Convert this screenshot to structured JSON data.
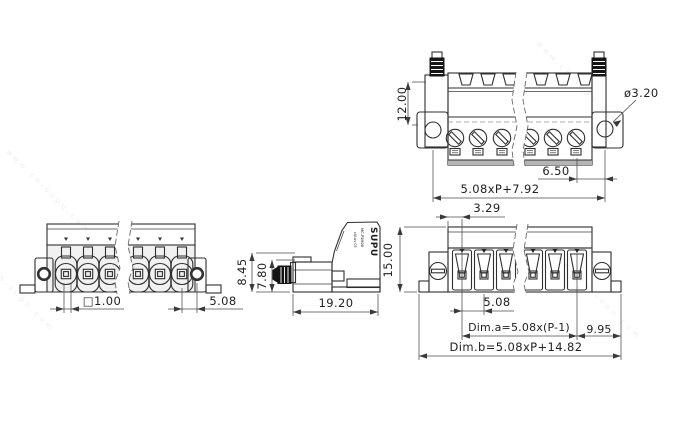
{
  "drawing": {
    "title": "terminal-block-technical-drawing",
    "line_color": "#2f2f2f",
    "dim_color": "#3a3a3a",
    "background": "#ffffff",
    "watermark": {
      "text": "www.cn-supu.com"
    },
    "brand": {
      "logo": "SUPU",
      "model": "MC-P5M08",
      "cert": "cULus CE"
    },
    "views": {
      "socket_front": {
        "dims": {
          "height_to_hole": "12.00",
          "hole_diameter": "ø3.20",
          "pole_to_hole": "6.50",
          "hole_span": "5.08xP+7.92"
        }
      },
      "plug_front": {
        "dims": {
          "edge_to_pole": "3.29",
          "height": "15.00",
          "pitch": "5.08",
          "dim_a": "Dim.a=5.08x(P-1)",
          "pole_to_edge": "9.95",
          "dim_b": "Dim.b=5.08xP+14.82"
        }
      },
      "side": {
        "dims": {
          "upper_height": "8.45",
          "screw_height": "7.80",
          "depth": "19.20"
        }
      },
      "header_front": {
        "dims": {
          "pin_square": "□1.00",
          "pole_to_hole": "5.08"
        }
      }
    }
  }
}
